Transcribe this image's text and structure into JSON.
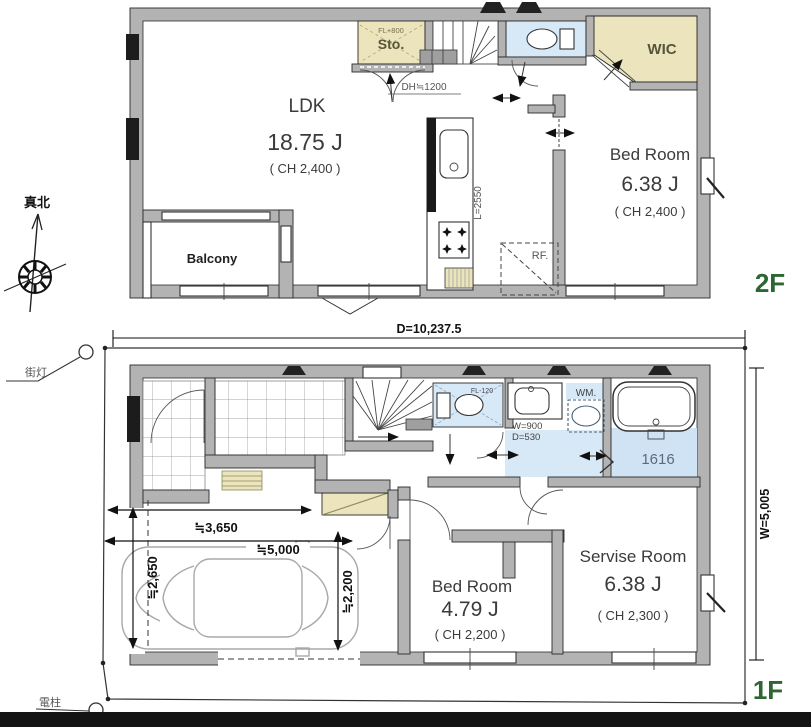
{
  "compass": {
    "north_label": "真北"
  },
  "site": {
    "streetlight_label": "街灯",
    "utility_pole_label": "電柱",
    "depth_dim": "D=10,237.5",
    "width_dim": "W=5,005"
  },
  "floor2": {
    "floor_label": "2F",
    "ldk_name": "LDK",
    "ldk_size": "18.75 J",
    "ldk_ch": "( CH 2,400 )",
    "bedroom_name": "Bed Room",
    "bedroom_size": "6.38 J",
    "bedroom_ch": "( CH 2,400 )",
    "wic_label": "WIC",
    "storage_label": "Sto.",
    "storage_fl": "FL+800",
    "balcony_label": "Balcony",
    "fridge_label": "RF.",
    "door_height": "DH≒1200",
    "kitchen_counter": "L=2550"
  },
  "floor1": {
    "floor_label": "1F",
    "bedroom_name": "Bed Room",
    "bedroom_size": "4.79 J",
    "bedroom_ch": "( CH 2,200 )",
    "service_name": "Servise Room",
    "service_size": "6.38 J",
    "service_ch": "( CH 2,300 )",
    "wm_label": "WM.",
    "bath_label": "1616",
    "toilet_fl": "FL-120",
    "basin_w": "W=900",
    "basin_d": "D=530",
    "dim_3650": "≒3,650",
    "dim_5000": "≒5,000",
    "dim_2650": "≒2,650",
    "dim_2200": "≒2,200"
  },
  "colors": {
    "wall_gray": "#b3b3b3",
    "room_beige": "#ece4bd",
    "room_blue": "#d7e8f6",
    "floor_label_green": "#2c6632"
  }
}
